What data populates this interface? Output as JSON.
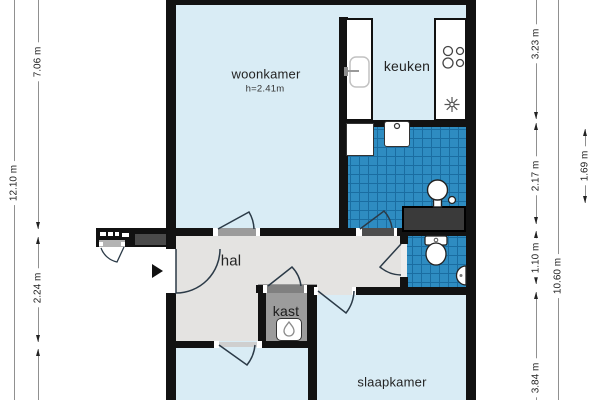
{
  "plan": {
    "type": "floor-plan",
    "language": "nl"
  },
  "rooms": {
    "woonkamer": {
      "label": "woonkamer",
      "height_note": "h=2.41m"
    },
    "keuken": {
      "label": "keuken"
    },
    "hal": {
      "label": "hal"
    },
    "kast": {
      "label": "kast"
    },
    "slaapkamer": {
      "label": "slaapkamer"
    }
  },
  "dims": {
    "left_total": "12.10 m",
    "left_top": "7.06 m",
    "left_mid": "2.24 m",
    "right_top": "3.23 m",
    "right_mid": "2.17 m",
    "right_low": "1.10 m",
    "right_bottom": "3.84 m",
    "right_total": "10.60 m",
    "right_inner": "1.69 m"
  },
  "fixtures": [
    "kitchen-sink-icon",
    "hob-icon",
    "extractor-icon",
    "shower-icon",
    "washing-machine-icon",
    "bath-icon",
    "washbasin-icon",
    "toilet-icon",
    "hand-basin-icon",
    "water-heater-flame-icon",
    "entrance-arrow-icon"
  ],
  "colors": {
    "room_fill": "#d9ecf5",
    "hall_fill": "#e4e3e1",
    "closet_fill": "#9c9c9c",
    "tile_fill": "#2e8cc1",
    "tile_line": "#1a6da1",
    "wall": "#121212",
    "bath_fill": "#3a3a3a"
  }
}
